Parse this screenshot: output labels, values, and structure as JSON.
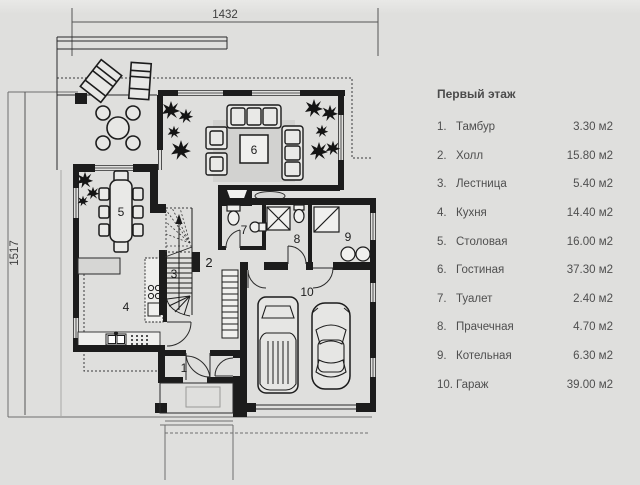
{
  "plan": {
    "dimension_top": "1432",
    "dimension_left": "1517",
    "rooms": {
      "r1": "1",
      "r2": "2",
      "r3": "3",
      "r4": "4",
      "r5": "5",
      "r6": "6",
      "r7": "7",
      "r8": "8",
      "r9": "9",
      "r10": "10"
    },
    "colors": {
      "background": "#dfdfdd",
      "wall": "#1c1c1c",
      "rug": "#d2d2d0",
      "line": "#2a2a2a"
    }
  },
  "legend": {
    "title": "Первый этаж",
    "items": [
      {
        "num": "1.",
        "name": "Тамбур",
        "area": "3.30 м2"
      },
      {
        "num": "2.",
        "name": "Холл",
        "area": "15.80 м2"
      },
      {
        "num": "3.",
        "name": "Лестница",
        "area": "5.40 м2"
      },
      {
        "num": "4.",
        "name": "Кухня",
        "area": "14.40 м2"
      },
      {
        "num": "5.",
        "name": "Столовая",
        "area": "16.00 м2"
      },
      {
        "num": "6.",
        "name": "Гостиная",
        "area": "37.30 м2"
      },
      {
        "num": "7.",
        "name": "Туалет",
        "area": "2.40 м2"
      },
      {
        "num": "8.",
        "name": "Прачечная",
        "area": "4.70 м2"
      },
      {
        "num": "9.",
        "name": "Котельная",
        "area": "6.30 м2"
      },
      {
        "num": "10.",
        "name": "Гараж",
        "area": "39.00 м2"
      }
    ]
  }
}
